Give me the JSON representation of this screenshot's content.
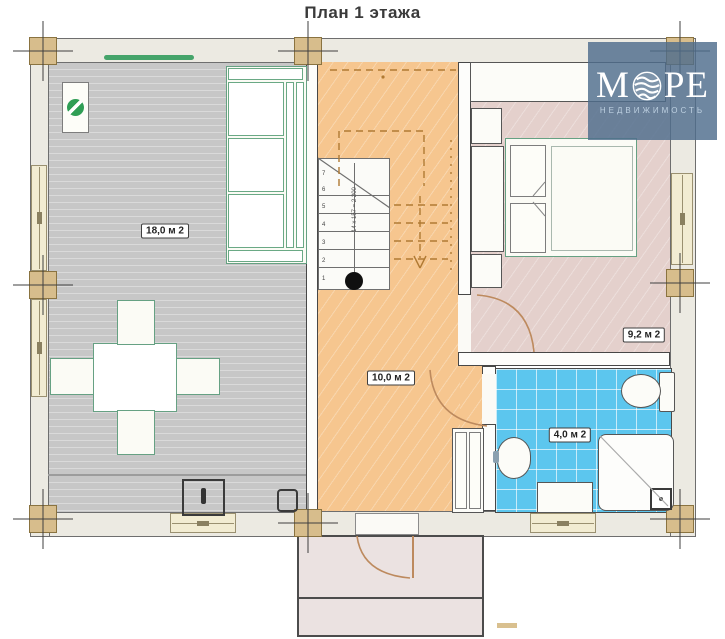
{
  "title": "План 1 этажа",
  "logo": {
    "word_start": "М",
    "word_end": "РЕ",
    "subtitle": "НЕДВИЖИМОСТЬ"
  },
  "rooms": {
    "living": {
      "area_label": "18,0 м 2"
    },
    "hall": {
      "area_label": "10,0 м 2",
      "stair_note": "14 x 157 = 2 200",
      "step_numbers": [
        "1",
        "2",
        "3",
        "4",
        "5",
        "6",
        "7"
      ]
    },
    "bedroom": {
      "area_label": "9,2 м 2"
    },
    "bathroom": {
      "area_label": "4,0 м 2"
    }
  },
  "colors": {
    "hall_orange": "#f6c68f",
    "living_gray": "#c7c7c7",
    "bedroom_pink": "#e4d0cc",
    "bathroom_blue": "#5cc6ee",
    "wood_post": "#d7bd8c",
    "furniture_green": "#66a183",
    "logo_blue": "#4e6c8c",
    "wall_stipple": "#eceae2"
  }
}
